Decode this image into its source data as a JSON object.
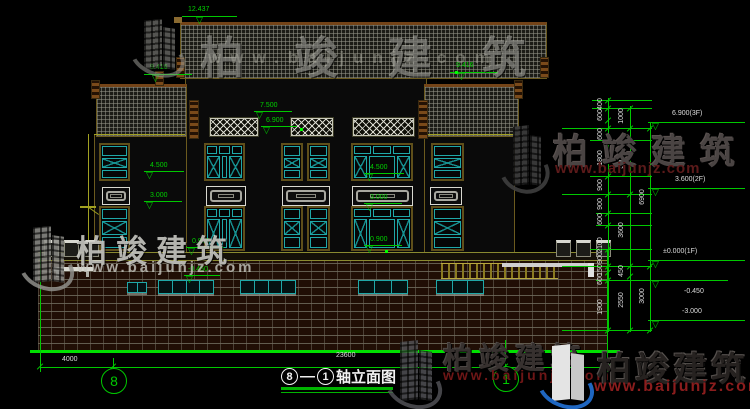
{
  "brand": {
    "name": "柏竣建筑",
    "url": "www.baijunjz.com"
  },
  "title": {
    "axis_from": "8",
    "separator": "—",
    "axis_to": "1",
    "suffix": "轴立面图"
  },
  "axis_bubbles": [
    {
      "label": "8",
      "x": 101,
      "y": 368
    },
    {
      "label": "1",
      "x": 493,
      "y": 366
    }
  ],
  "bottom_dims": [
    {
      "text": "4000",
      "x": 62,
      "y": 356
    },
    {
      "text": "23600",
      "x": 336,
      "y": 352
    }
  ],
  "facade_elevations": [
    {
      "text": "12.437",
      "tx": 188,
      "ty": 6,
      "lx": 182,
      "lw": 55,
      "ly": 16,
      "ax": 196
    },
    {
      "text": "9.416",
      "tx": 150,
      "ty": 64,
      "lx": 144,
      "lw": 48,
      "ly": 74,
      "ax": 152
    },
    {
      "text": "9.416",
      "tx": 456,
      "ty": 62,
      "lx": 450,
      "lw": 48,
      "ly": 72,
      "ax": 458
    },
    {
      "text": "7.500",
      "tx": 260,
      "ty": 102,
      "lx": 254,
      "lw": 38,
      "ly": 111,
      "ax": 256
    },
    {
      "text": "6.900",
      "tx": 266,
      "ty": 117,
      "lx": 261,
      "lw": 36,
      "ly": 126,
      "ax": 263
    },
    {
      "text": "4.500",
      "tx": 150,
      "ty": 162,
      "lx": 144,
      "lw": 40,
      "ly": 171,
      "ax": 146
    },
    {
      "text": "4.500",
      "tx": 370,
      "ty": 164,
      "lx": 364,
      "lw": 40,
      "ly": 173,
      "ax": 366
    },
    {
      "text": "3.000",
      "tx": 150,
      "ty": 192,
      "lx": 144,
      "lw": 38,
      "ly": 201,
      "ax": 146
    },
    {
      "text": "3.000",
      "tx": 370,
      "ty": 194,
      "lx": 364,
      "lw": 38,
      "ly": 203,
      "ax": 366
    },
    {
      "text": "0.900",
      "tx": 192,
      "ty": 238,
      "lx": 186,
      "lw": 38,
      "ly": 247,
      "ax": 188
    },
    {
      "text": "0.900",
      "tx": 370,
      "ty": 236,
      "lx": 364,
      "lw": 38,
      "ly": 245,
      "ax": 366
    },
    {
      "text": "-0.450",
      "tx": 188,
      "ty": 266,
      "lx": 184,
      "lw": 36,
      "ly": 275,
      "ax": 186
    }
  ],
  "right_elevations": [
    {
      "text": "6.900(3F)",
      "tx": 672,
      "ty": 110,
      "lx": 648,
      "lw": 97,
      "ly": 122,
      "ax": 652
    },
    {
      "text": "3.600(2F)",
      "tx": 675,
      "ty": 176,
      "lx": 648,
      "lw": 97,
      "ly": 188,
      "ax": 652
    },
    {
      "text": "±0.000(1F)",
      "tx": 663,
      "ty": 248,
      "lx": 648,
      "lw": 97,
      "ly": 260,
      "ax": 652
    },
    {
      "text": "-0.450",
      "tx": 684,
      "ty": 288,
      "lx": 648,
      "lw": 80,
      "ly": 280,
      "ax": 652
    },
    {
      "text": "-3.000",
      "tx": 682,
      "ty": 308,
      "lx": 648,
      "lw": 97,
      "ly": 320,
      "ax": 652
    }
  ],
  "right_dims": {
    "chain1_x": 601,
    "chain2_x": 622,
    "chain3_x": 643,
    "chain1": [
      {
        "t": "400",
        "y": 104
      },
      {
        "t": "600",
        "y": 115
      },
      {
        "t": "600",
        "y": 134
      },
      {
        "t": "1800",
        "y": 158
      },
      {
        "t": "900",
        "y": 185
      },
      {
        "t": "900",
        "y": 204
      },
      {
        "t": "600",
        "y": 219
      },
      {
        "t": "2100",
        "y": 245
      },
      {
        "t": "900",
        "y": 258
      },
      {
        "t": "150",
        "y": 270
      },
      {
        "t": "600",
        "y": 279
      },
      {
        "t": "1900",
        "y": 307
      }
    ],
    "chain2": [
      {
        "t": "1000",
        "y": 116
      },
      {
        "t": "3300",
        "y": 161
      },
      {
        "t": "3600",
        "y": 230
      },
      {
        "t": "450",
        "y": 271
      },
      {
        "t": "2550",
        "y": 300
      }
    ],
    "chain3": [
      {
        "t": "6900",
        "y": 197
      },
      {
        "t": "3000",
        "y": 296
      }
    ]
  },
  "colors": {
    "cad_green": "#00c800",
    "window_cyan": "#1fa8a8",
    "frame_olive": "#6b5a1e",
    "fascia_brown": "#744418",
    "watermark_red": "#8b1d1d",
    "dim_text": "#dcdcdc"
  }
}
